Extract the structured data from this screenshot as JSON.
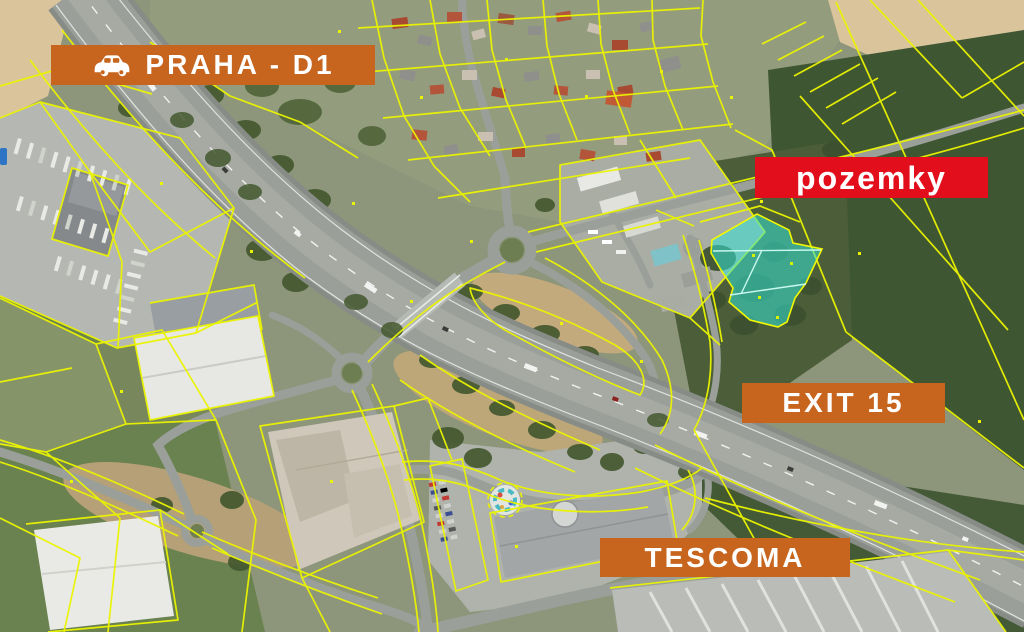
{
  "scene": {
    "description": "Aerial cadastral map of the D1 motorway Exit 15 area with highlighted building plots for sale",
    "cadastral_line_color": "#ebf400",
    "highlight": {
      "fill": "#35e3d5",
      "fill_opacity": 0.55,
      "outline": "#f2f800",
      "inner_line_color": "#c9f8ef",
      "subparcel_count": 4
    }
  },
  "labels": {
    "route": {
      "text": "PRAHA - D1",
      "bg": "#c7641d",
      "fg": "#ffffff"
    },
    "parcels": {
      "text": "pozemky",
      "bg": "#e30e1b",
      "fg": "#ffffff"
    },
    "exit": {
      "text": "EXIT 15",
      "bg": "#c7641d",
      "fg": "#ffffff"
    },
    "store": {
      "text": "TESCOMA",
      "bg": "#c7641d",
      "fg": "#ffffff"
    }
  },
  "icons": {
    "route": "car-icon"
  }
}
